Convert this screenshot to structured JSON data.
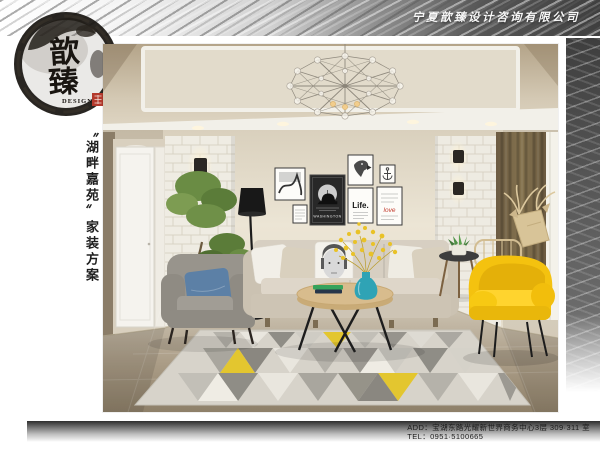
{
  "header": {
    "company_name": "宁夏歆臻设计咨询有限公司"
  },
  "logo": {
    "brand_char_top": "歆",
    "brand_char_bottom": "臻",
    "brand_subtitle": "DESIGN"
  },
  "side": {
    "project_title": "〝湖畔嘉苑〟家装方案"
  },
  "photo": {
    "poster_washington": "WASHINGTON",
    "poster_life": "Life.",
    "poster_love": "love"
  },
  "footer": {
    "address": "ADD：宝湖东路光耀新世界商务中心3层 309·311 室",
    "tel": "TEL：0951·5100665"
  },
  "colors": {
    "brand_ink": "#1c1a18",
    "seal_red": "#b3392c",
    "accent_yellow": "#f2c00e",
    "vase_teal": "#2fa3b5",
    "band_gray": "#565656"
  }
}
